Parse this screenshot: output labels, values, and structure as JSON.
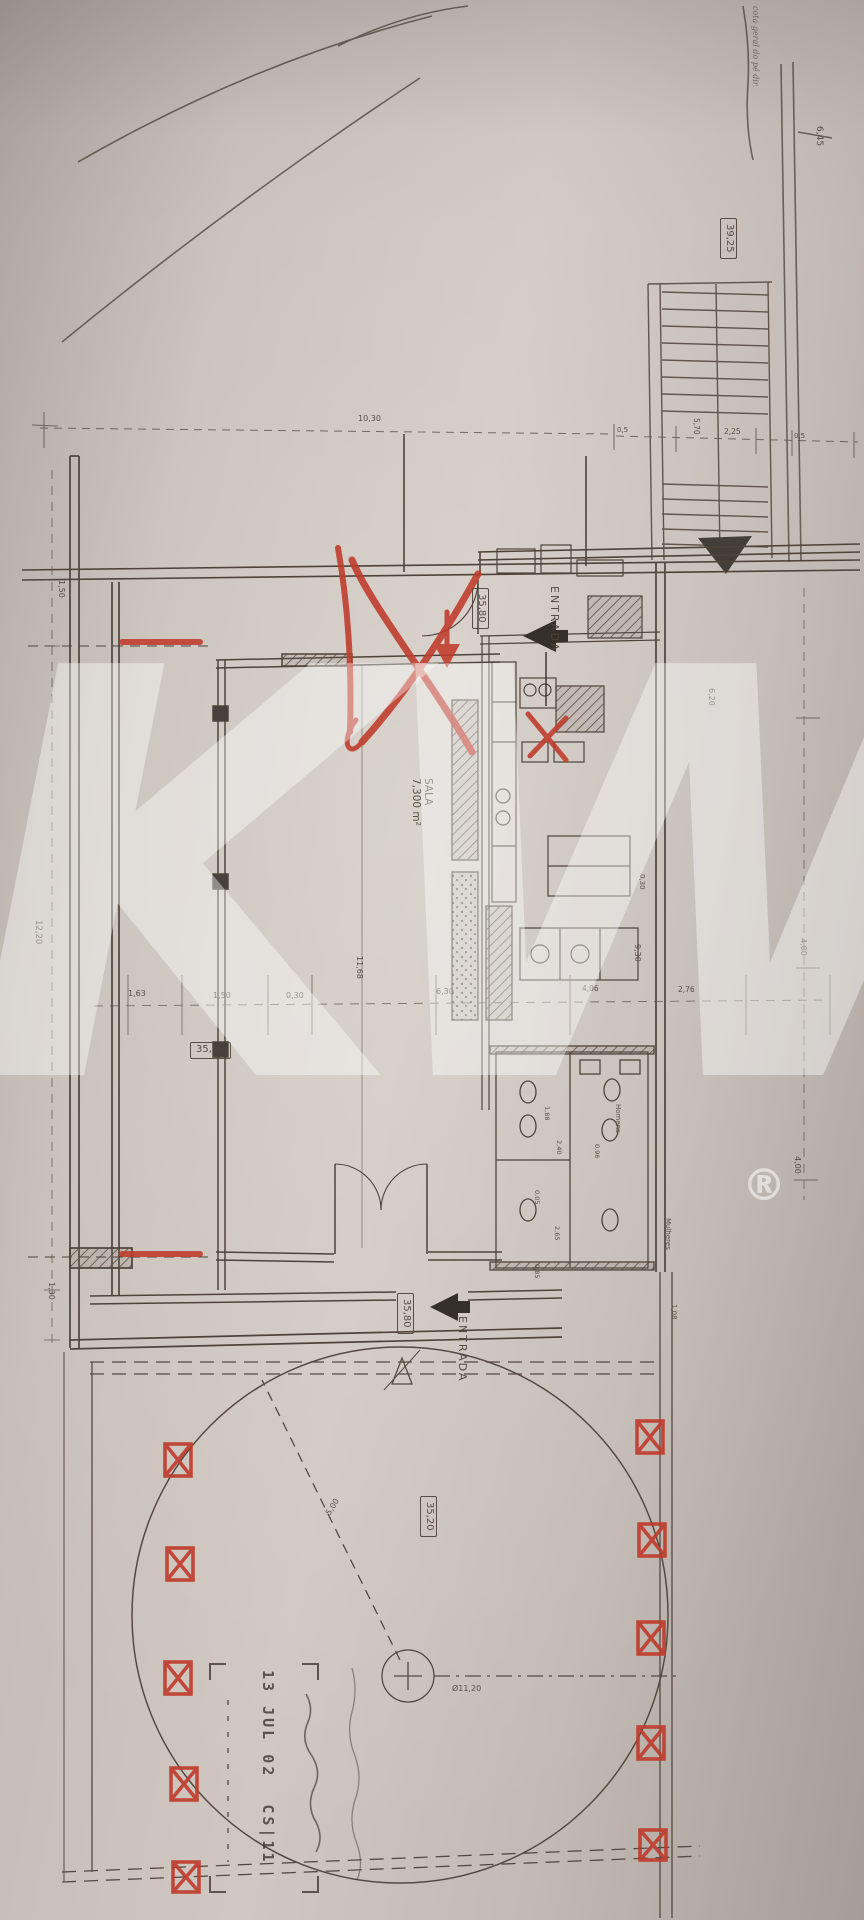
{
  "document": {
    "kind": "scanned architectural floor plan photo"
  },
  "colors": {
    "paper": "#c6beb6",
    "ink": "#4e4439",
    "red_marker": "#bf3a2b",
    "stamp": "#453e35",
    "watermark": "rgba(255,255,255,0.40)"
  },
  "watermark": {
    "text": "KW",
    "registered": "®"
  },
  "site_note": {
    "text": "cota geral do pé dir.",
    "level": "6,45"
  },
  "levels": {
    "upper_box": "39,25",
    "entrance_top_box": "35,80",
    "hall_box": "35,80",
    "entrance_bottom_box": "35,80",
    "terrace_box": "35,20"
  },
  "entrances": {
    "top": "ENTRADA",
    "bottom": "ENTRADA"
  },
  "rooms": {
    "sala": {
      "name": "SALA",
      "area": "7,300 m²"
    },
    "men": "Homens",
    "women": "Mulheres"
  },
  "circle": {
    "diameter": "Ø11,20",
    "radius": "5,00"
  },
  "stamp": {
    "date": "13 JUL 02",
    "ref": "CS|11"
  },
  "dimensions": {
    "top": [
      "10,30",
      "0,5",
      "5,70",
      "2,25",
      "0,5"
    ],
    "left": [
      "1,50",
      "12,20",
      "1,30"
    ],
    "middle": [
      "1,63",
      "1,50",
      "0,30",
      "11,68",
      "6,30",
      "4,06",
      "2,76"
    ],
    "right": [
      "6,20",
      "0,30",
      "9,30",
      "4,00",
      "4,00",
      "1,08"
    ],
    "services": [
      "1,88",
      "2,40",
      "0,96",
      "0,05",
      "2,65",
      "0,85"
    ]
  }
}
